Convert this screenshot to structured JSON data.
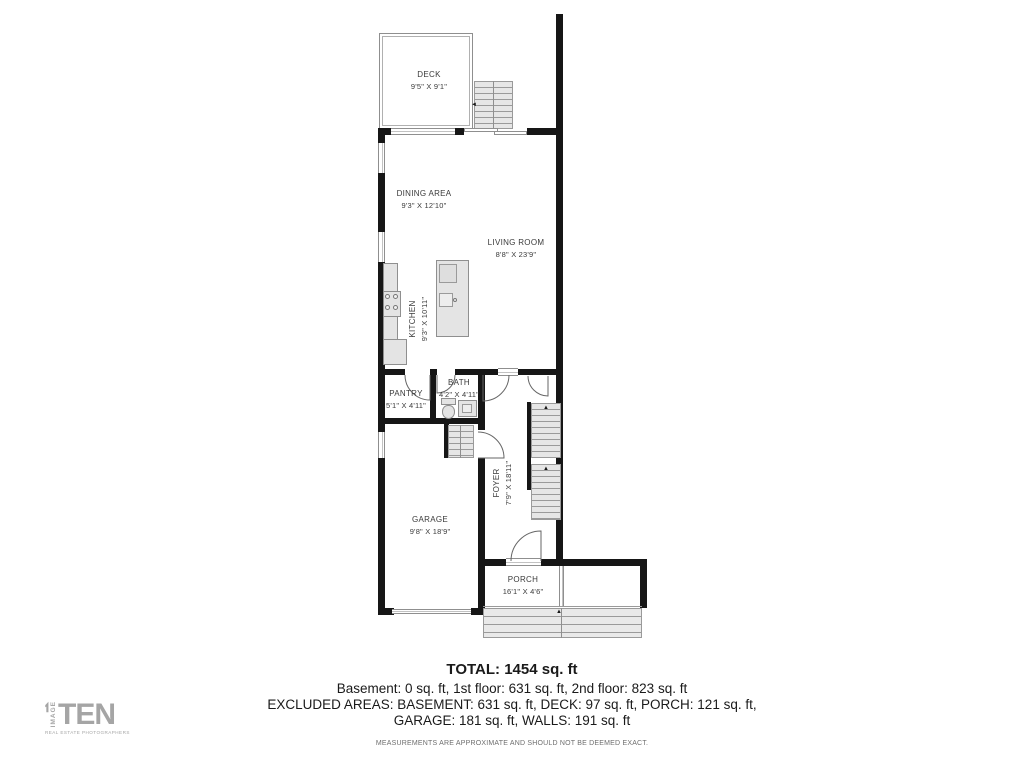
{
  "rooms": [
    {
      "name": "DECK",
      "dims": "9'5\" X 9'1\""
    },
    {
      "name": "DINING AREA",
      "dims": "9'3\" X 12'10\""
    },
    {
      "name": "LIVING ROOM",
      "dims": "8'8\" X 23'9\""
    },
    {
      "name": "KITCHEN",
      "dims": "9'3\" X 10'11\""
    },
    {
      "name": "PANTRY",
      "dims": "5'1\" X 4'11\""
    },
    {
      "name": "BATH",
      "dims": "4'2\" X 4'11\""
    },
    {
      "name": "GARAGE",
      "dims": "9'8\" X 18'9\""
    },
    {
      "name": "FOYER",
      "dims": "7'9\" X 18'11\""
    },
    {
      "name": "PORCH",
      "dims": "16'1\" X 4'6\""
    }
  ],
  "summary": {
    "total": "TOTAL: 1454 sq. ft",
    "line1": "Basement: 0 sq. ft, 1st floor: 631 sq. ft, 2nd floor: 823 sq. ft",
    "line2": "EXCLUDED AREAS: BASEMENT: 631 sq. ft, DECK: 97 sq. ft, PORCH: 121 sq. ft,",
    "line3": "GARAGE: 181 sq. ft, WALLS: 191 sq. ft",
    "disclaimer": "MEASUREMENTS ARE APPROXIMATE AND SHOULD NOT BE DEEMED EXACT."
  },
  "logo": {
    "vertical_text": "IMAGE",
    "main_text": "TEN",
    "tagline": "REAL ESTATE PHOTOGRAPHERS"
  },
  "icons": {
    "up_arrow": "▲",
    "left_arrow": "◄"
  },
  "colors": {
    "wall": "#161616",
    "fixture_fill": "#e4e4e4",
    "fixture_border": "#8f8f8f",
    "logo_gray": "#a5a5a5",
    "label_text": "#3a3a3a"
  }
}
